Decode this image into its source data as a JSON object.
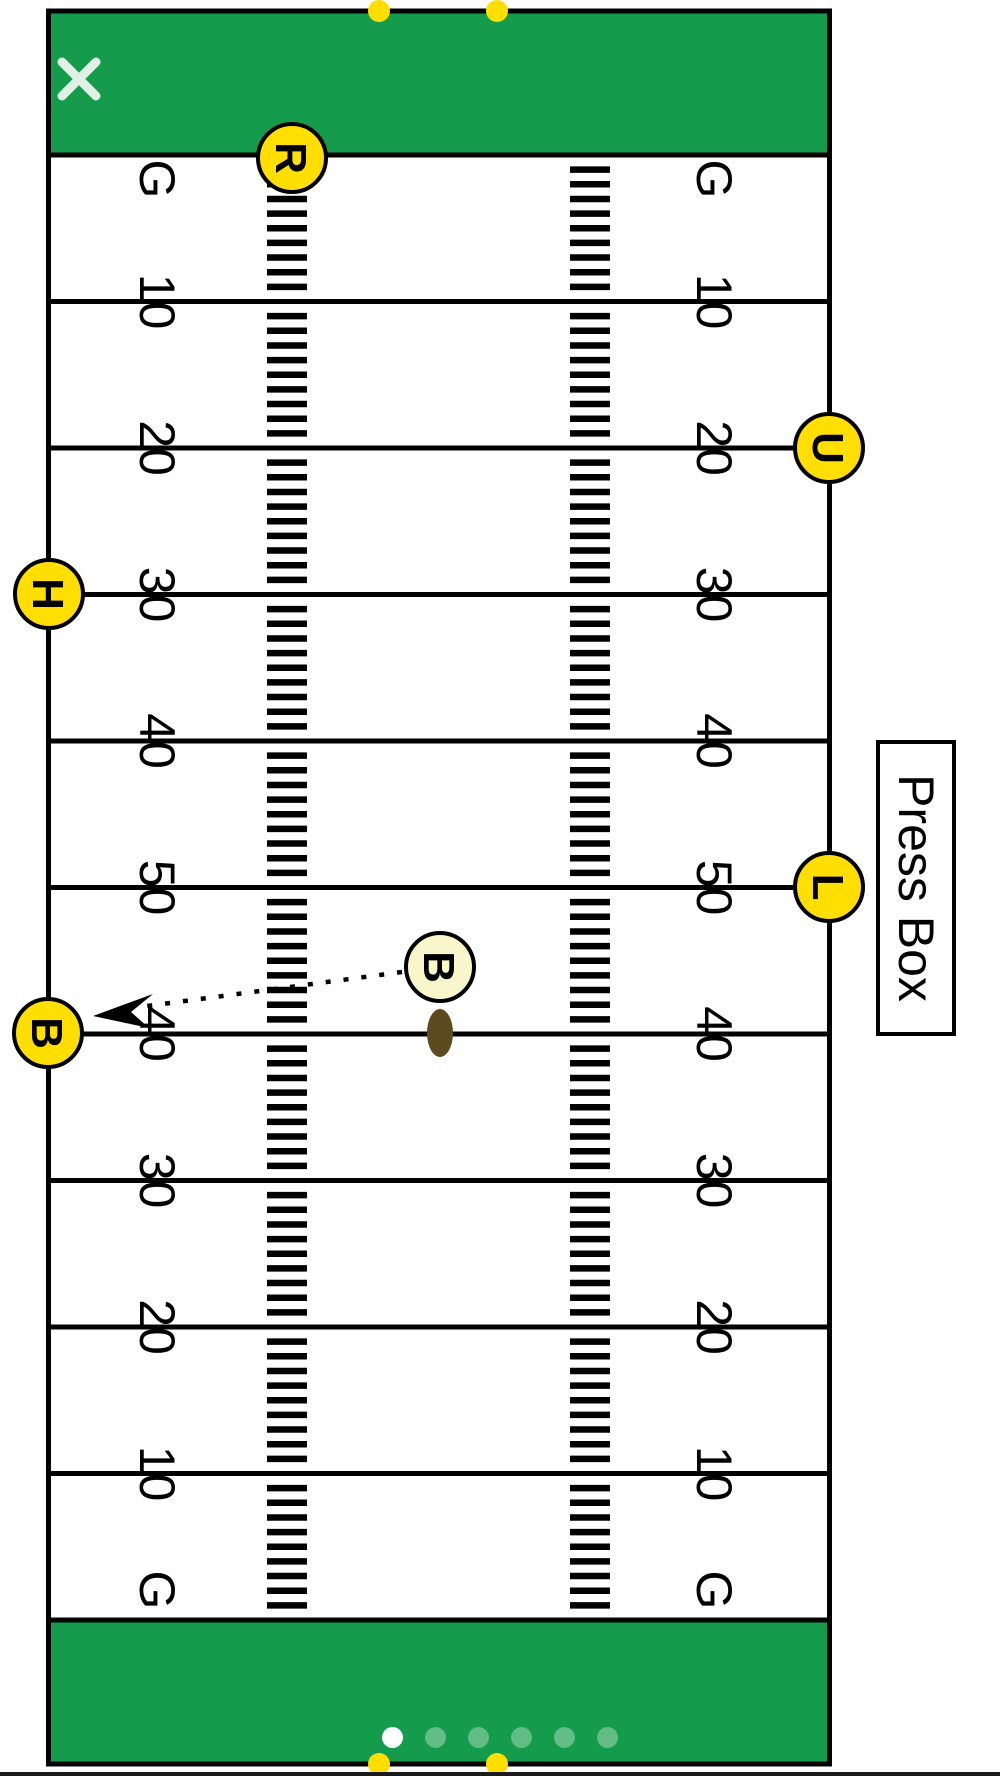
{
  "app": {
    "icons": {
      "close_icon": "✕",
      "page_dot": "●",
      "pylon_dot": "●"
    }
  },
  "press_box": {
    "label": "Press Box"
  },
  "field": {
    "yard_labels": [
      "G",
      "10",
      "20",
      "30",
      "40",
      "50",
      "40",
      "30",
      "20",
      "10",
      "G"
    ],
    "officials": [
      {
        "letter": "R",
        "x": 292,
        "y": 158,
        "variant": "current"
      },
      {
        "letter": "U",
        "x": 829,
        "y": 448,
        "variant": "current"
      },
      {
        "letter": "H",
        "x": 49,
        "y": 594,
        "variant": "current"
      },
      {
        "letter": "L",
        "x": 829,
        "y": 887,
        "variant": "current"
      },
      {
        "letter": "B",
        "x": 48,
        "y": 1033,
        "variant": "current"
      },
      {
        "letter": "B",
        "x": 440,
        "y": 967,
        "variant": "previous"
      }
    ],
    "ball": {
      "x": 440,
      "y": 1033
    },
    "movement_arrow": {
      "from_x": 402,
      "from_y": 972,
      "to_x": 140,
      "to_y": 1007,
      "tip_x": 93,
      "tip_y": 1016
    },
    "goalpost_dot_xs": [
      379,
      497
    ],
    "colors": {
      "turf_green": "#149B4B",
      "marker_yellow": "#FFDE00",
      "previous_marker_cream": "#FAF6CC",
      "ball_brown": "#5C4B1E",
      "line_black": "#000000",
      "close_icon_color": "#E0F1E3"
    }
  },
  "carousel": {
    "dot_count": 6,
    "active_index": 0
  }
}
